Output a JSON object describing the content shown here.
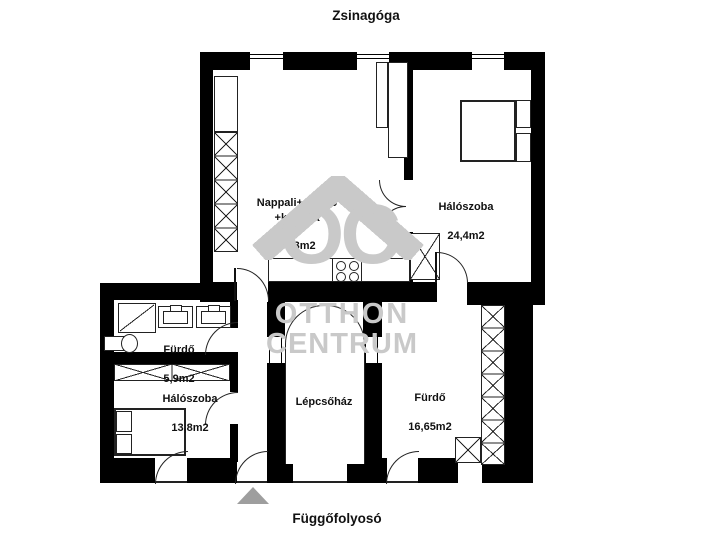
{
  "labels": {
    "top": "Zsinagóga",
    "bottom": "Függőfolyosó"
  },
  "rooms": {
    "living": {
      "name": "Nappali+étkező\n+konyha",
      "area": "40,3m2"
    },
    "bedroom_large": {
      "name": "Hálószoba",
      "area": "24,4m2"
    },
    "bathroom_small": {
      "name": "Fürdő",
      "area": "5,9m2"
    },
    "bedroom_small": {
      "name": "Hálószoba",
      "area": "13,8m2"
    },
    "staircase": {
      "name": "Lépcsőház",
      "area": ""
    },
    "bathroom_large": {
      "name": "Fürdő",
      "area": "16,65m2"
    }
  },
  "watermark": {
    "initials": "OC",
    "line1": "OTTHON",
    "line2": "CENTRUM"
  },
  "colors": {
    "wall": "#000000",
    "outline": "#222222",
    "watermark": "#c9c9c9",
    "north_arrow": "#9e9e9e",
    "background": "#ffffff"
  }
}
